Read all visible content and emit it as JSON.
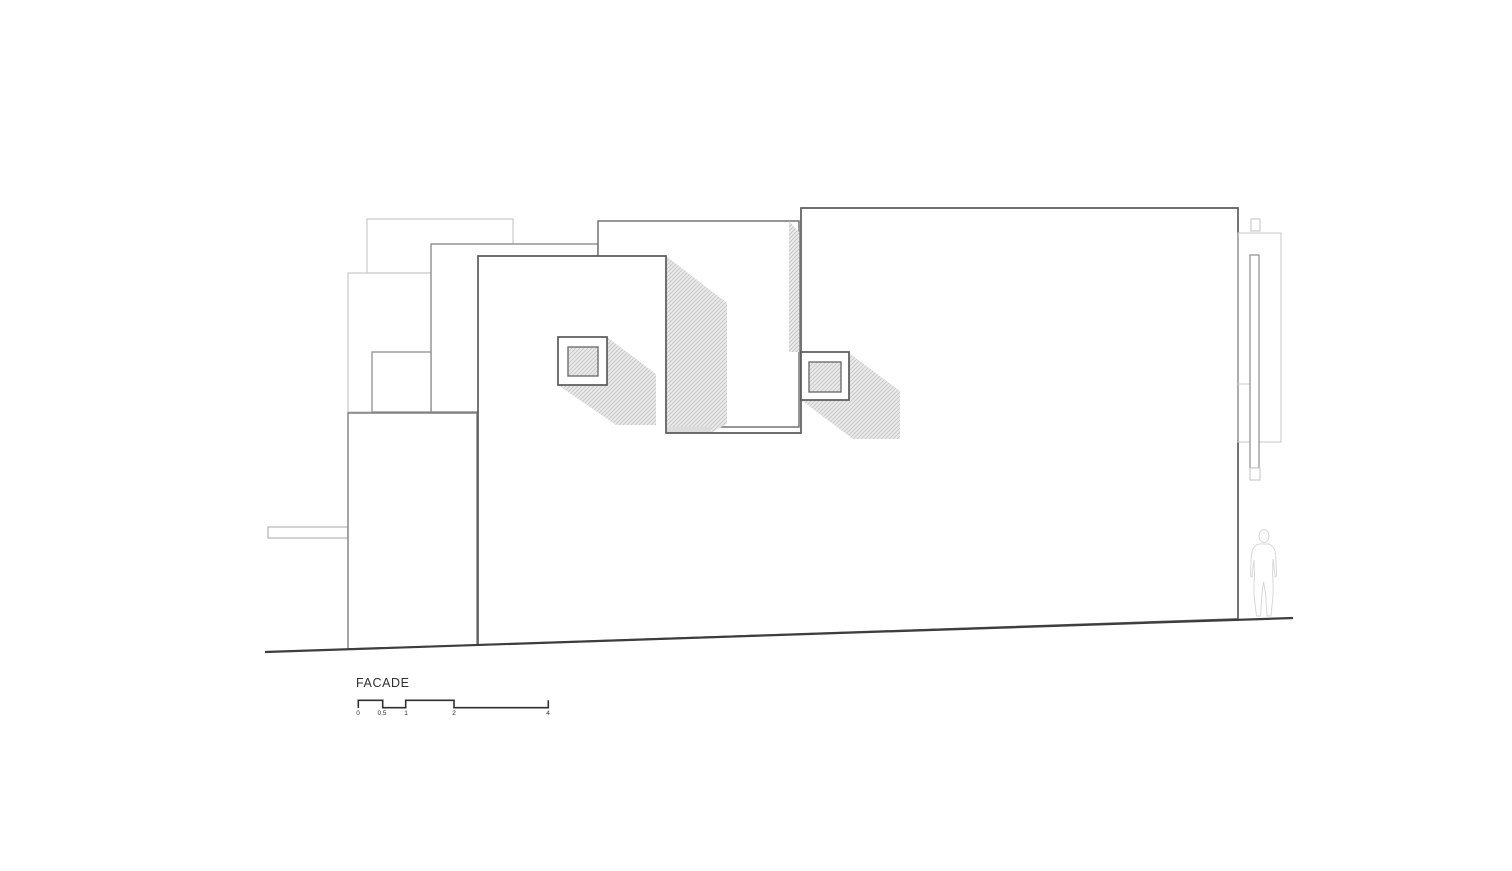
{
  "page": {
    "background_color": "#ffffff",
    "kind": "architectural elevation drawing"
  },
  "titleblock": {
    "drawing_label": "FACADE",
    "scale_bar": {
      "ticks": [
        "0",
        "0.5",
        "1",
        "2",
        "4"
      ],
      "unit_values": [
        0,
        0.5,
        1,
        2,
        4
      ]
    }
  },
  "drawing": {
    "colors": {
      "outline_dark": "#5b5b5b",
      "outline_medium": "#848484",
      "outline_light": "#c9c9c9",
      "hatch_fill": "#eaeaea",
      "hatch_line": "#c6c6c6",
      "shadow_solid": "#dcdcdc",
      "ground_line": "#3d3d3d",
      "text": "#2f2f2f",
      "figure_outline": "#d8d8d8"
    },
    "elements": [
      "back-volume-upper-left",
      "back-volume-left",
      "volume-a",
      "volume-c",
      "volume-d",
      "volume-b-shadow",
      "volume-d-base-shadow",
      "volume-e-edge-shadow",
      "canopy",
      "volume-f",
      "main-wall",
      "window-1",
      "window-2",
      "side-panel",
      "side-post",
      "human-figure",
      "ground-line",
      "scale-bar"
    ]
  }
}
